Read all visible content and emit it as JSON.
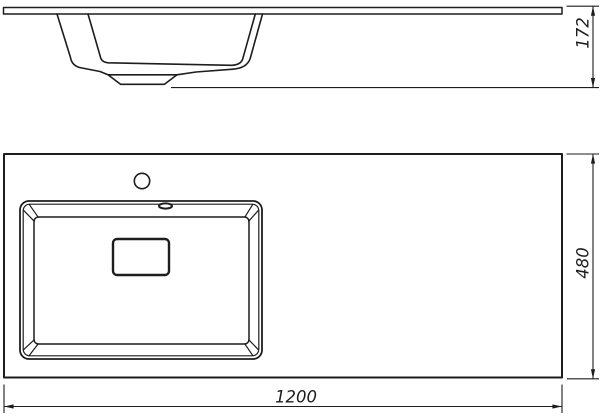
{
  "drawing": {
    "type": "sink-technical-drawing",
    "views": {
      "side_view": "side-elevation",
      "plan_view": "top-plan"
    }
  },
  "dimensions": {
    "height": "172",
    "depth": "480",
    "width": "1200"
  },
  "colors": {
    "line": "#1d1d1d",
    "background": "#ffffff"
  }
}
